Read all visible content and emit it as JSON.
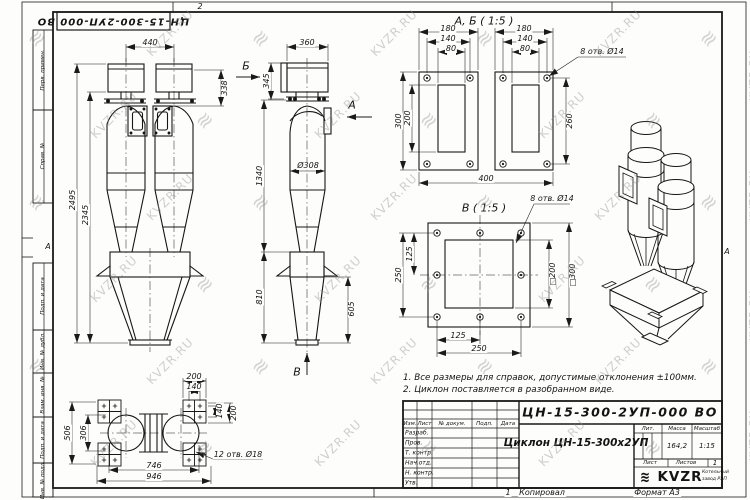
{
  "doc": {
    "designation": "ЦН-15-300-2УП-000 ВО",
    "name": "Циклон ЦН-15-300х2УП"
  },
  "watermark": {
    "text": "KVZR.RU",
    "logo_glyph": "≋"
  },
  "frame": {
    "margin_labels": [
      "Перв. примен.",
      "Справ. №",
      "Подп. и дата",
      "Инв. № дубл.",
      "Взам. инв. №",
      "Подп. и дата",
      "Инв. № подл."
    ]
  },
  "notes": [
    "1. Все размеры для справок, допустимые отклонения ±100мм.",
    "2. Циклон поставляется в разобранном виде."
  ],
  "title_block": {
    "header_cols": [
      "Изм.",
      "Лист",
      "№ докум.",
      "Подп.",
      "Дата"
    ],
    "role_rows": [
      "Разраб.",
      "Пров.",
      "Т. контр.",
      "Нач.отд.",
      "Н. контр.",
      "Утв."
    ],
    "lit_label": "Лит.",
    "mass_label": "Масса",
    "mass_value": "164,2",
    "scale_label": "Масштаб",
    "scale_value": "1:15",
    "sheet_label": "Лист",
    "sheets_label": "Листов",
    "sheets_value": "1",
    "logo_text": "KVZR",
    "company_line1": "Котельный",
    "company_line2": "завод РЭП"
  },
  "labels": [
    {
      "t": "440",
      "x": 150,
      "y": 43
    },
    {
      "t": "2495",
      "x": 73,
      "y": 200,
      "r": -90
    },
    {
      "t": "2345",
      "x": 86,
      "y": 215,
      "r": -90
    },
    {
      "t": "338",
      "x": 225,
      "y": 88,
      "r": -90
    },
    {
      "t": "360",
      "x": 307,
      "y": 43
    },
    {
      "t": "345",
      "x": 267,
      "y": 81,
      "r": -90
    },
    {
      "t": "Б",
      "x": 246,
      "y": 66,
      "s": 11,
      "name": "view-arrow-letter-b"
    },
    {
      "t": "А",
      "x": 352,
      "y": 105,
      "s": 11,
      "name": "view-arrow-letter-a"
    },
    {
      "t": "Ø308",
      "x": 308,
      "y": 166
    },
    {
      "t": "1340",
      "x": 260,
      "y": 176,
      "r": -90
    },
    {
      "t": "810",
      "x": 260,
      "y": 297,
      "r": -90
    },
    {
      "t": "605",
      "x": 352,
      "y": 309,
      "r": -90
    },
    {
      "t": "В",
      "x": 297,
      "y": 372,
      "s": 11,
      "name": "view-arrow-letter-v"
    },
    {
      "t": "А, Б ( 1:5 )",
      "x": 484,
      "y": 21,
      "s": 11,
      "name": "view-title-ab"
    },
    {
      "t": "180",
      "x": 448,
      "y": 29
    },
    {
      "t": "140",
      "x": 448,
      "y": 39
    },
    {
      "t": "80",
      "x": 451,
      "y": 49
    },
    {
      "t": "180",
      "x": 524,
      "y": 29
    },
    {
      "t": "140",
      "x": 525,
      "y": 39
    },
    {
      "t": "80",
      "x": 525,
      "y": 49
    },
    {
      "t": "300",
      "x": 399,
      "y": 121,
      "r": -90
    },
    {
      "t": "200",
      "x": 408,
      "y": 118,
      "r": -90
    },
    {
      "t": "260",
      "x": 570,
      "y": 121,
      "r": -90
    },
    {
      "t": "400",
      "x": 486,
      "y": 179
    },
    {
      "t": "8 отв. Ø14",
      "x": 602,
      "y": 52,
      "name": "hole-note"
    },
    {
      "t": "В ( 1:5 )",
      "x": 484,
      "y": 208,
      "s": 11,
      "name": "view-title-v"
    },
    {
      "t": "8 отв. Ø14",
      "x": 552,
      "y": 199,
      "name": "hole-note"
    },
    {
      "t": "250",
      "x": 399,
      "y": 275,
      "r": -90
    },
    {
      "t": "125",
      "x": 410,
      "y": 254,
      "r": -90
    },
    {
      "t": "□200",
      "x": 553,
      "y": 274,
      "r": -90
    },
    {
      "t": "□300",
      "x": 573,
      "y": 275,
      "r": -90
    },
    {
      "t": "125",
      "x": 458,
      "y": 336
    },
    {
      "t": "250",
      "x": 479,
      "y": 349
    },
    {
      "t": "200",
      "x": 194,
      "y": 377
    },
    {
      "t": "140",
      "x": 194,
      "y": 387
    },
    {
      "t": "140",
      "x": 220,
      "y": 411,
      "r": -90
    },
    {
      "t": "200",
      "x": 234,
      "y": 413,
      "r": -90
    },
    {
      "t": "506",
      "x": 68,
      "y": 433,
      "r": -90
    },
    {
      "t": "306",
      "x": 84,
      "y": 433,
      "r": -90
    },
    {
      "t": "746",
      "x": 154,
      "y": 466
    },
    {
      "t": "946",
      "x": 154,
      "y": 477
    },
    {
      "t": "12 отв. Ø18",
      "x": 238,
      "y": 455,
      "name": "hole-note"
    },
    {
      "t": "2",
      "x": 200,
      "y": 7,
      "name": "zone-number-top"
    },
    {
      "t": "1",
      "x": 508,
      "y": 493,
      "name": "zone-number-bottom"
    },
    {
      "t": "А",
      "x": 48,
      "y": 247,
      "s": 8,
      "name": "zone-letter-left"
    },
    {
      "t": "А",
      "x": 727,
      "y": 252,
      "s": 8,
      "name": "zone-letter-right"
    },
    {
      "t": "Копировал",
      "x": 542,
      "y": 493,
      "name": "copied-label"
    },
    {
      "t": "Формат А3",
      "x": 657,
      "y": 493,
      "name": "format-label"
    }
  ]
}
